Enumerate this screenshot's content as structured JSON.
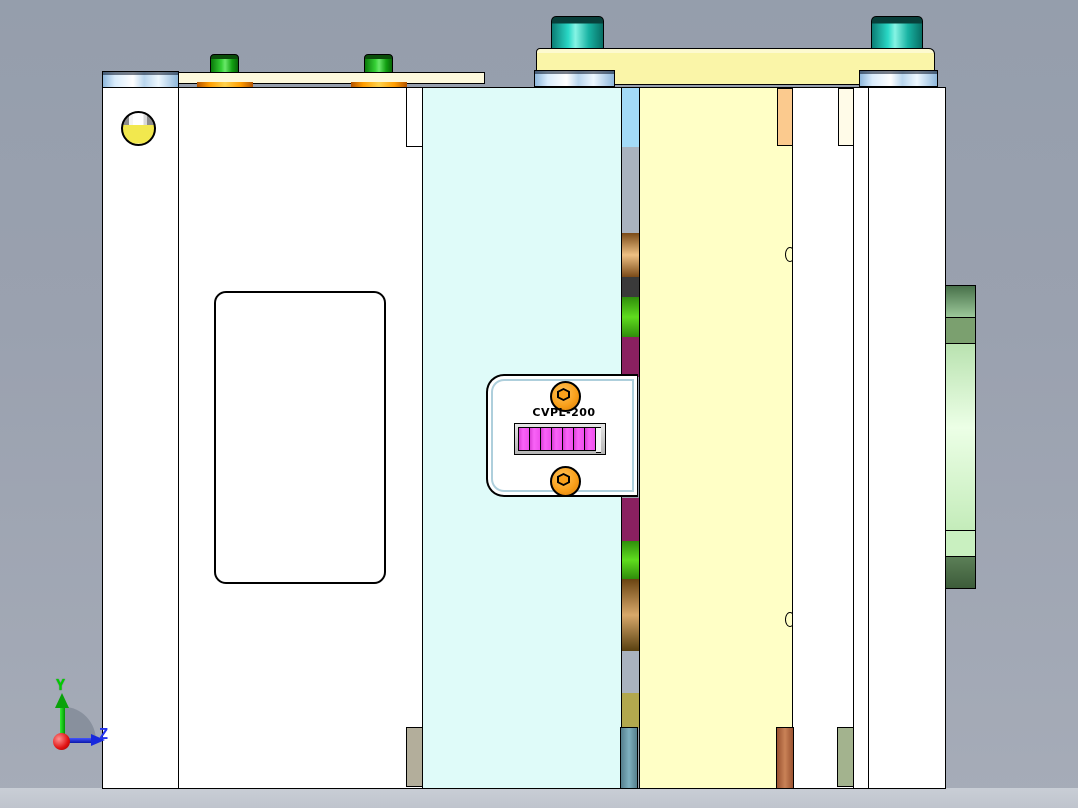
{
  "viewport": {
    "width": 1078,
    "height": 808,
    "background_top": "#959eac",
    "background_bottom": "#a6acb8",
    "floor_color": "#c9ced6"
  },
  "model": {
    "counter": {
      "label": "CVPL-200",
      "display_cells": 7,
      "display_color": "#ee4fec",
      "body_color": "#ffffff",
      "bolt_color": "#f9a01b",
      "trim_color": "#aecfdc"
    },
    "plates": {
      "left_white": "#ffffff",
      "cavity_cyan": "#dffbf9",
      "core_yellow": "#ffffc6",
      "top_clamp_yellow": "#faf5a8",
      "top_thin_cream": "#fdf9dc"
    },
    "hardware": {
      "green_bolt": "#35cf35",
      "teal_bolt": "#2ad8c6",
      "washer_blue": "#d9ecfc",
      "orange_ring": "#ff9d00",
      "locating_ring_green_light": "#ecffe6",
      "locating_ring_green_dark": "#4e6f4a",
      "pillar_teal": "#6f9fae",
      "pillar_brown": "#b97148",
      "pillar_tan": "#b3ae9b",
      "pillar_sage": "#a3b38e",
      "eyebolt_yellow": "#f2e84e",
      "insert_sky": "#a3daf7",
      "insert_orange": "#fbca8e",
      "insert_cream": "#fffbe8"
    }
  },
  "axis_triad": {
    "y_label": "Y",
    "z_label": "Z",
    "y_color": "#00cc00",
    "z_color": "#2233ee",
    "origin_color": "#e01010"
  }
}
